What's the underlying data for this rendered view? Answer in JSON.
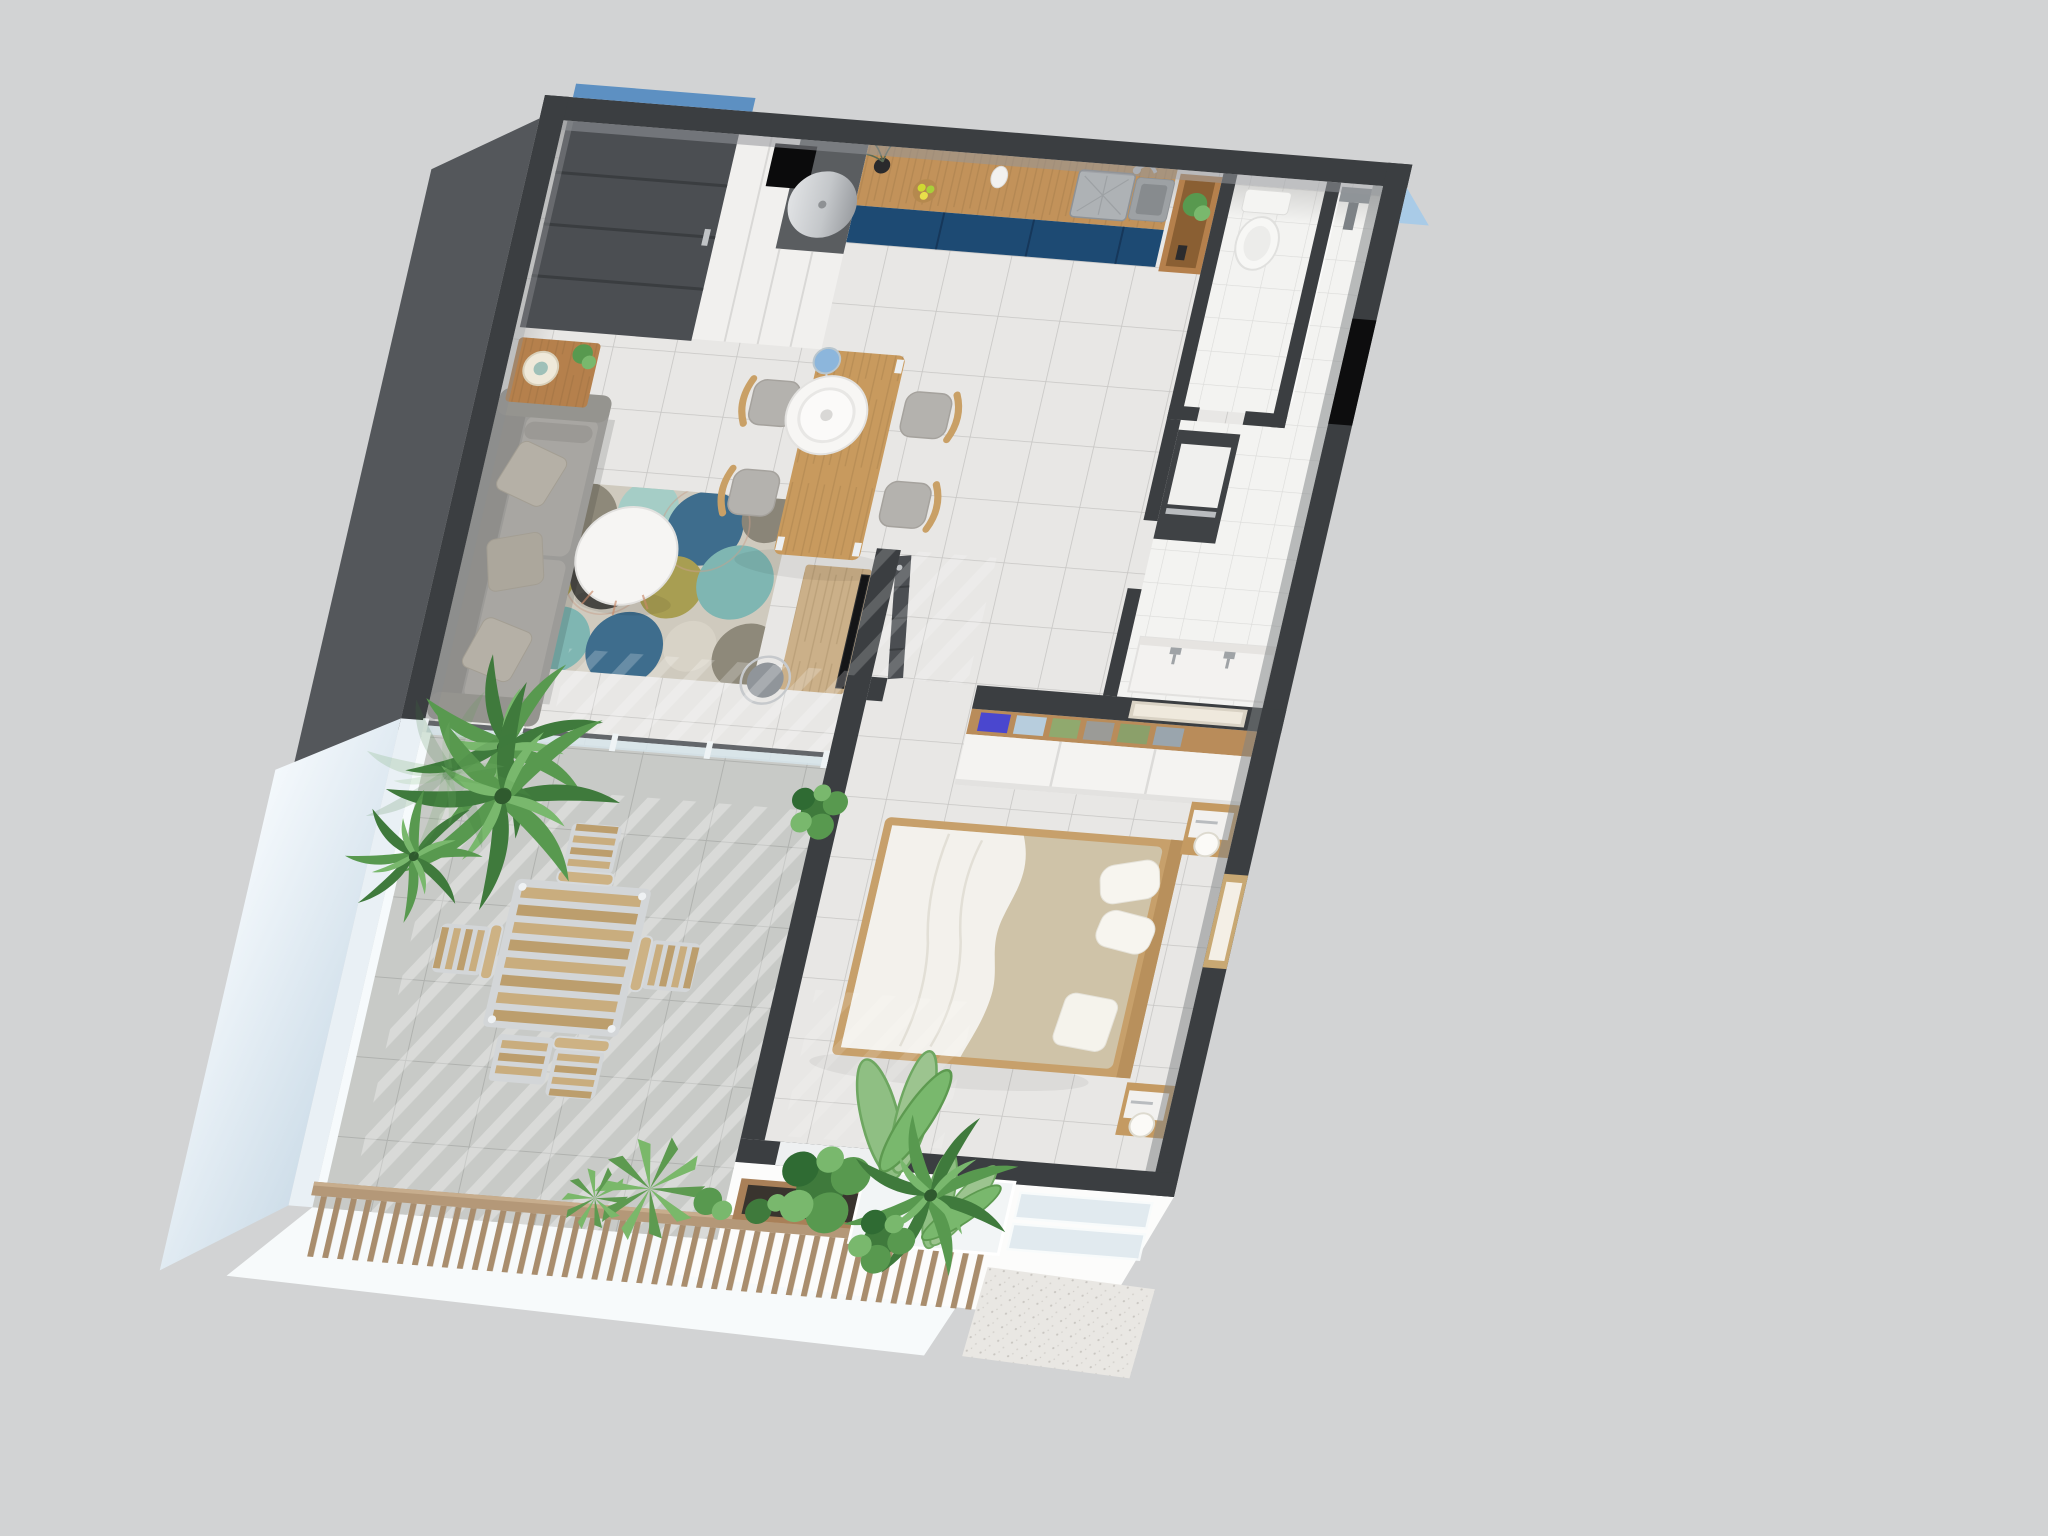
{
  "meta": {
    "title": "3D floor plan render — one-bedroom apartment with terrace, top-down dollhouse view",
    "view": "axonometric top view, plan rotated slightly clockwise",
    "background_note": "plain light gray studio background, no text or UI controls visible"
  },
  "palette": {
    "background": "#d2d3d4",
    "wall_dark": "#3b3e41",
    "wall_dark_face": "#54575b",
    "wall_white": "#efeeec",
    "floor_tile": "#e8e7e5",
    "floor_grout": "#c7c6c4",
    "wc_tile": "#f3f3f1",
    "terrace_tile": "#c8cac7",
    "terrace_wall": "#e9f0f5",
    "kitchen_cabinet_navy": "#1d4a73",
    "counter_wood": "#c2925a",
    "table_wood": "#c89a5e",
    "sofa_gray": "#9c9b98",
    "rug_base": "#cfcabe",
    "rug_circle_colors": [
      "#3e6d8d",
      "#7fb6b2",
      "#a5cdc6",
      "#a89e52",
      "#8e897a",
      "#4d4c47"
    ],
    "bed_frame_wood": "#c7a06b",
    "bedding_beige": "#cfc3a8",
    "duvet_white": "#f3f1ec",
    "plant_greens": [
      "#3f7a3c",
      "#58994f",
      "#79b86d",
      "#9cc48f"
    ],
    "railing_wood": "#b49878",
    "exterior_accent_blue": "#5d90c2",
    "corner_glass_blue": "#a9cbe7",
    "door_dark": "#4b4e52",
    "window_black": "#0d0d0e"
  },
  "rooms": {
    "entry": {
      "label": "Entry zone — dark paneled front door and white utility closet with water heater",
      "furniture": [
        "front-door",
        "storage-closet",
        "water-heater",
        "duct-opening"
      ]
    },
    "kitchen": {
      "label": "Kitchen — navy blue base cabinets, wood countertop, stainless sink",
      "furniture": [
        "counter",
        "sink",
        "faucet",
        "vase-with-branches",
        "fruit-bowl",
        "pitcher",
        "niche-shelf-with-plant"
      ]
    },
    "wc": {
      "label": "WC — toilet in separate water closet",
      "furniture": [
        "toilet"
      ]
    },
    "bathroom": {
      "label": "Shower room — walk-in shower, vanity with wall taps, utility column",
      "furniture": [
        "shower-panel",
        "glass-screen",
        "vanity",
        "wall-taps",
        "appliance-column",
        "black-window"
      ]
    },
    "hall": {
      "label": "Hallway with open dark interior door",
      "furniture": [
        "open-door"
      ]
    },
    "dining": {
      "label": "Dining area — wood table, four chairs, white pendant lamp",
      "furniture": [
        "dining-table",
        "chairs-x4",
        "pendant-lamp"
      ]
    },
    "living": {
      "label": "Living room — gray sofa, circle-pattern rug, round white coffee table, TV desk",
      "furniture": [
        "sofa",
        "throw-pillows",
        "side-table-with-lamp",
        "coffee-table",
        "rug",
        "tv-desk",
        "tv",
        "desk-chair",
        "palm-plant"
      ]
    },
    "bedroom": {
      "label": "Bedroom — double bed with white duvet, wardrobe with folded clothes, nightstands with lamps, wall mirror",
      "furniture": [
        "double-bed",
        "pillows",
        "wardrobe",
        "folded-clothes",
        "nightstand-x2",
        "lamps",
        "mirror-niche"
      ]
    },
    "terrace": {
      "label": "Terrace — slatted outdoor table with four chairs, palm plants, wood slat railing",
      "furniture": [
        "outdoor-table",
        "outdoor-chairs-x4",
        "slat-stool",
        "palms",
        "planter",
        "railing"
      ]
    },
    "exterior": {
      "label": "Exterior — white outer walls, planter with tropical plants, glass-railed entrance steps with stone mat",
      "furniture": [
        "planter-box",
        "monstera",
        "banana-plant",
        "agave",
        "glass-panels",
        "stone-step"
      ]
    }
  }
}
